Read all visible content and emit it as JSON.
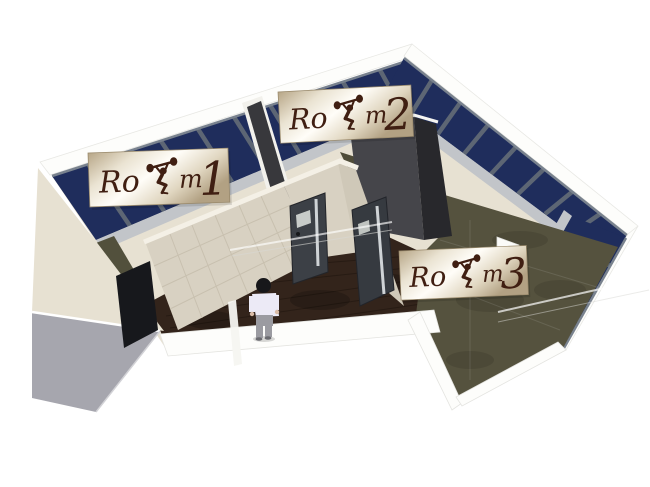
{
  "labels": {
    "room1": {
      "prefix": "Ro",
      "suffix": "m",
      "number": "1"
    },
    "room2": {
      "prefix": "Ro",
      "suffix": "m",
      "number": "2"
    },
    "room3": {
      "prefix": "Ro",
      "suffix": "m",
      "number": "3"
    }
  },
  "icons": {
    "weightlifter": "weightlifter-overhead-squat-silhouette (used as the second o of Room)"
  },
  "colors": {
    "glass": "#1f2d5c",
    "mullion": "#5d6674",
    "wall_cream": "#e7e1d2",
    "wall_tile": "#d8d1c2",
    "tile_grid": "#c7bfae",
    "wall_charcoal": "#45454a",
    "wall_charcoal_dark": "#28282c",
    "floor_wood": "#33241b",
    "floor_carpet": "#55523e",
    "entry_pad": "#a6a6ae",
    "door": "#3c4046",
    "door_slit": "#cfd3d6",
    "sill": "#c2c5c9",
    "band_white": "#fdfdfb",
    "label_text": "#401f12"
  },
  "person": {
    "hair": "#17171a",
    "shirt": "#eceaf6",
    "pants": "#9b9ba1",
    "skin": "#d9bba6"
  }
}
